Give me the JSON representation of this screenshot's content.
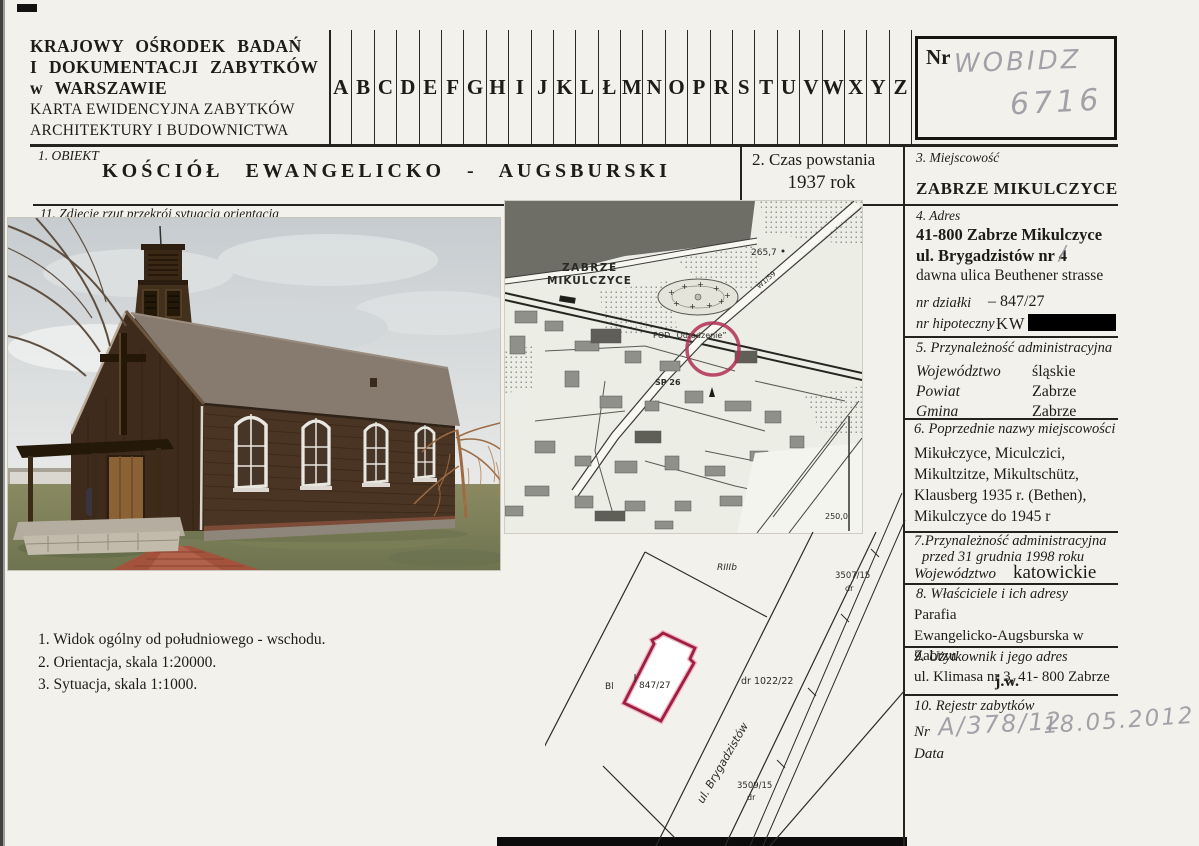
{
  "header": {
    "org_line1": "KRAJOWY  OŚRODEK   BADAŃ",
    "org_line2": "I  DOKUMENTACJI  ZABYTKÓW",
    "org_line3": "w  WARSZAWIE",
    "card_line1": "KARTA EWIDENCYJNA ZABYTKÓW",
    "card_line2": "ARCHITEKTURY I BUDOWNICTWA",
    "alphabet": [
      "A",
      "B",
      "C",
      "D",
      "E",
      "F",
      "G",
      "H",
      "I",
      "J",
      "K",
      "L",
      "Ł",
      "M",
      "N",
      "O",
      "P",
      "R",
      "S",
      "T",
      "U",
      "V",
      "W",
      "X",
      "Y",
      "Z"
    ],
    "nr_label": "Nr",
    "nr_handwritten_word": "WOBIDZ",
    "nr_handwritten_number": "6716"
  },
  "sections": {
    "s1": {
      "label": "1.   OBIEKT",
      "value": "KOŚCIÓŁ   EWANGELICKO - AUGSBURSKI"
    },
    "s2": {
      "label": "2.   Czas powstania",
      "value": "1937 rok"
    },
    "s3": {
      "label": "3.   Miejscowość",
      "value": "ZABRZE  MIKULCZYCE"
    },
    "s4": {
      "label": "4.   Adres",
      "line1": "41-800 Zabrze Mikulczyce",
      "line2": "ul. Brygadzistów  nr 4",
      "line3": "dawna ulica Beuthener strasse",
      "dzialki_label": "nr działki",
      "dzialki_value": "–   847/27",
      "hipoteczny_label": "nr hipoteczny",
      "hipoteczny_value": "KW"
    },
    "s5": {
      "label": "5.   Przynależność administracyjna",
      "rows": [
        {
          "k": "Województwo",
          "v": "śląskie"
        },
        {
          "k": "Powiat",
          "v": "Zabrze"
        },
        {
          "k": "Gmina",
          "v": "Zabrze"
        }
      ]
    },
    "s6": {
      "label": "6.   Poprzednie nazwy miejscowości",
      "lines": [
        "Mikułczyce, Miculczici,",
        "Mikultzitze, Mikultschütz,",
        "Klausberg 1935 r. (Bethen),",
        "Mikulczyce do 1945 r"
      ]
    },
    "s7": {
      "label_line1": "7.Przynależność administracyjna",
      "label_line2": "przed 31 grudnia 1998 roku",
      "k": "Województwo",
      "v": "katowickie"
    },
    "s8": {
      "label": "8.    Właściciele  i  ich  adresy",
      "lines": [
        "Parafia",
        "Ewangelicko-Augsburska w Zabrzu",
        "ul. Klimasa nr 3, 41- 800 Zabrze"
      ]
    },
    "s9": {
      "label": "9. Użytkownik  i jego adres",
      "value": "j.w."
    },
    "s10": {
      "label": "10. Rejestr zabytków",
      "nr_label": "Nr",
      "data_label": "Data",
      "nr_value": "A/378/12",
      "data_value": "18.05.2012"
    },
    "s11": {
      "label": "11.   Zdjęcie rzut przekrój sytuacja orientacja"
    }
  },
  "captions": {
    "items": [
      "1.   Widok ogólny od południowego - wschodu.",
      "2.   Orientacja, skala 1:20000.",
      "3.   Sytuacja, skala 1:1000."
    ]
  },
  "map": {
    "town_line1": "ZABRZE",
    "town_line2": "MIKULCZYCE",
    "elevation1": "265,7",
    "garden": "POD „Odrodzenie”",
    "school": "SP 26",
    "road": "W1/59",
    "elevation2": "250,0"
  },
  "siteplan": {
    "riiib": "RIIIb",
    "bl": "Bl",
    "parcel": "847/27",
    "road1": "dr  1022/22",
    "road2_nr": "3507/15",
    "road2_dr": "dr",
    "street": "ul. Brygadzistów",
    "road3_nr": "3509/15",
    "road3_dr": "dr"
  }
}
